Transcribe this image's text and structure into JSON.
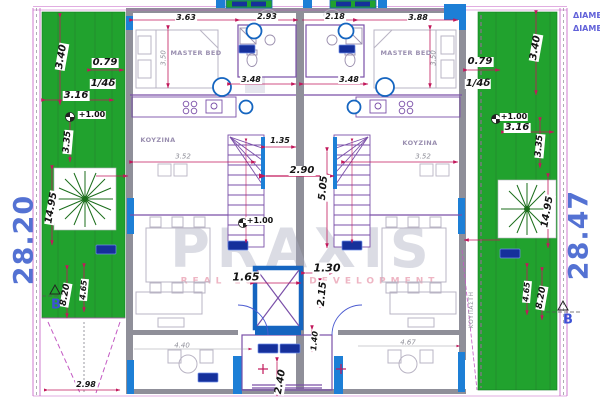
{
  "watermark": {
    "title": "PRAXIS",
    "subtitle": "REAL ESTATE DEVELOPMENT"
  },
  "left": {
    "overall": "28.20",
    "d1": "3.40",
    "d2": "0.79",
    "d3": "1/4δ",
    "d4": "3.16",
    "level": "+1.00",
    "d5": "3.35",
    "d6": "14.95",
    "d7": "8.20",
    "d8": "4.65",
    "section": "B",
    "ramp_dim": "2.98"
  },
  "right": {
    "overall": "28.47",
    "d1": "3.40",
    "d2": "0.79",
    "d3": "1/4δ",
    "d4": "3.16",
    "level": "+1.00",
    "d5": "3.35",
    "d6": "14.95",
    "d7": "8.20",
    "d8": "4.65",
    "section": "B",
    "corner1": "ΔΙΑΜΕΡΟ",
    "corner2": "ΔΙΑΜΕΡΟ",
    "side_note": "ΚΟΥΠΑΣΤΗ"
  },
  "top_dims": {
    "t1": "3.63",
    "t2": "2.93",
    "t3": "2.18",
    "t4": "3.88"
  },
  "rooms": {
    "master_left": "MASTER BED",
    "master_right": "MASTER BED",
    "kitchen_left": "KOYZINA",
    "kitchen_right": "KOYZINA"
  },
  "interior": {
    "bed_l": "3.50",
    "bed_r": "3.50",
    "k_l": "3.52",
    "k_r": "3.52",
    "land1": "3.48",
    "land2": "3.48",
    "corr_t": "1.35",
    "corr_w": "2.90",
    "stair_h": "5.05",
    "level": "+1.00",
    "elev": "1.65",
    "c1": "1.30",
    "c2": "2.15",
    "c3": "1.40",
    "c4": "2.40",
    "b1": "4.40",
    "b2": "4.67"
  }
}
